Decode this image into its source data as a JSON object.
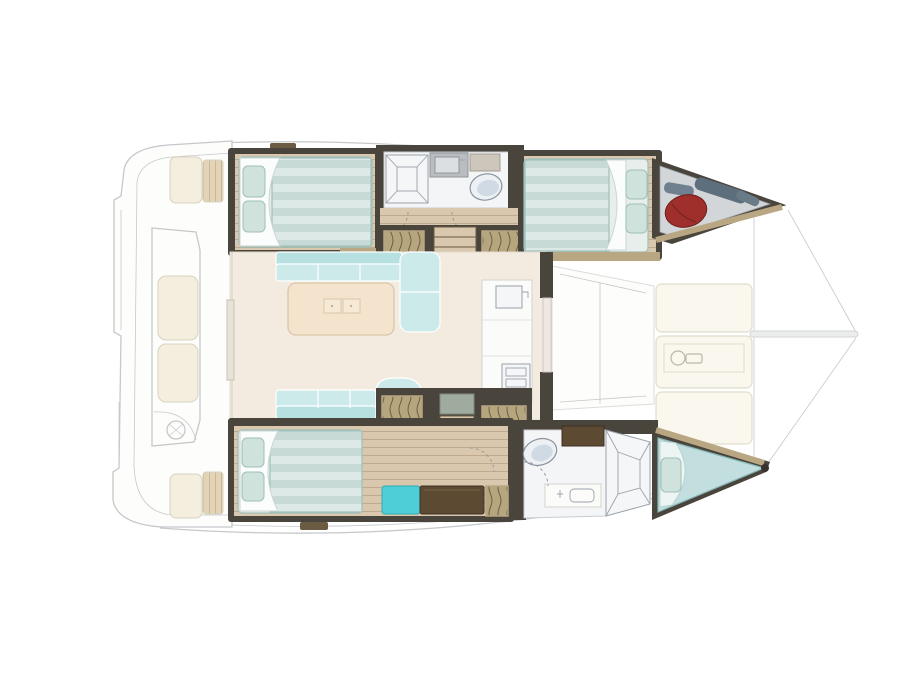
{
  "diagram": {
    "type": "yacht-floorplan",
    "subject": "catamaran interior layout, top view",
    "orientation": "bow-right",
    "double_beds": 3,
    "bathrooms": 2,
    "forepeak_berths": 1
  },
  "palette": {
    "ghost_line": "#c6c8ca",
    "wall_dark": "#49443c",
    "wall_darker": "#37322b",
    "trim_wood": "#b9a683",
    "floor_wood": "#d9c7ae",
    "salon_floor": "#f3ebdf",
    "mattress_base": "#e7eeec",
    "mattress_light": "#dde9e6",
    "mattress_dark": "#c8dad6",
    "mattress_edge": "#9fc0ba",
    "pillow": "#cfe2dc",
    "sheet_white": "#fbfcfc",
    "sofa_mint": "#cdeaea",
    "sofa_mint_dark": "#b7e0e0",
    "table_cream": "#f4e4ce",
    "table_edge": "#d9c6a8",
    "stool_teal": "#4ecfd8",
    "desk_brown": "#5d4a33",
    "hatch_khaki": "#b6a67e",
    "hatch_line": "#6b5f45",
    "bath_floor": "#f4f5f6",
    "toilet_blue": "#c4d2e0",
    "fender_red": "#9e2f2b",
    "bag_gray": "#5d6e7c",
    "berth_teal": "#c2dede",
    "cushion_cream": "#f4eedf",
    "cushion_edge": "#d9d2bf",
    "cushion_tan": "#e3d4b8",
    "deckpad_cream": "#faf7ee",
    "landing_sage": "#9fab9e",
    "bow_locker_deck": "#d3d6d8"
  }
}
